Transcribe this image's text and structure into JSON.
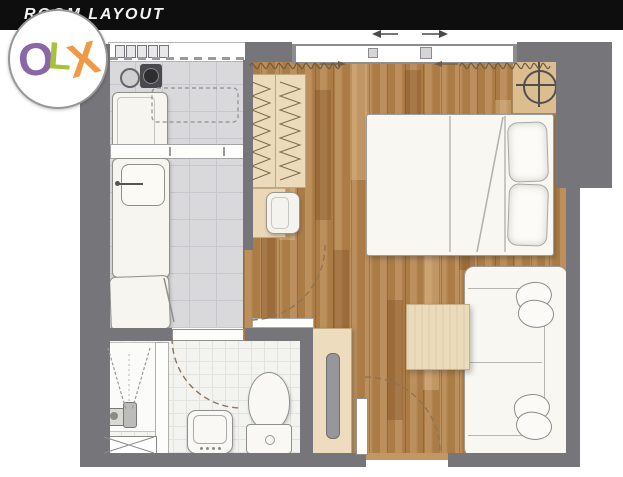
{
  "header": {
    "title": "ROOM LAYOUT"
  },
  "logo": {
    "letters": [
      {
        "char": "O",
        "color": "#8a68a8"
      },
      {
        "char": "L",
        "color": "#a6c23c"
      },
      {
        "char": "X",
        "color": "#f09a48"
      }
    ],
    "background": "#ffffff"
  },
  "palette": {
    "header_bg": "#0e0e0e",
    "wall": "#76767a",
    "wood_floor": "#b5834b",
    "kitchen_tile": "#d9d9dc",
    "bath_tile": "#f3f3f0",
    "light_wood_furniture": "#ecdbbb",
    "white_furniture": "#f8f7f2"
  },
  "floorplan": {
    "type": "studio-room-layout",
    "rooms": [
      {
        "name": "kitchen",
        "floor": "gray-tile",
        "items": [
          "shelf-jars",
          "stove-burners",
          "overhead-cabinet-dashed",
          "washing-machine",
          "counter-shelf",
          "sink-with-faucet",
          "counter",
          "refrigerator"
        ]
      },
      {
        "name": "bathroom",
        "floor": "white-tile",
        "items": [
          "shower-corner",
          "floor-drain",
          "shower-head",
          "glass-partition",
          "bath-mat",
          "swing-door",
          "washbasin",
          "toilet"
        ]
      },
      {
        "name": "living-bedroom",
        "floor": "wood-plank",
        "items": [
          "sliding-window",
          "slide-arrows",
          "curtains",
          "wardrobe-with-hangers",
          "desk",
          "chair",
          "double-bed",
          "blanket-fold",
          "pillows",
          "nightstand",
          "table-lamp",
          "sofa",
          "sofa-cushions",
          "coffee-table",
          "shoe-cabinet",
          "entrance-swing-door",
          "kitchen-door-arc",
          "threshold-bar"
        ]
      }
    ]
  }
}
